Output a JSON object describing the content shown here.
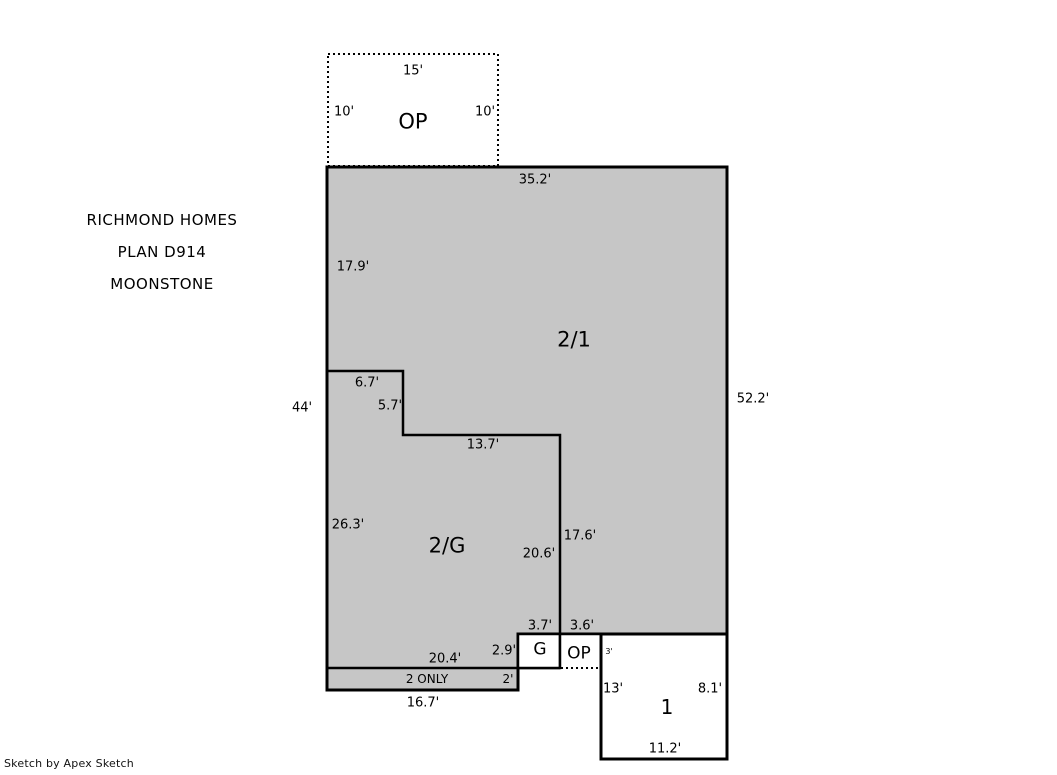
{
  "title_block": {
    "lines": [
      "RICHMOND HOMES",
      "PLAN D914",
      "MOONSTONE"
    ]
  },
  "watermark": {
    "text": "Sketch by Apex Sketch"
  },
  "colors": {
    "area_fill": "#c6c6c6",
    "outline": "#000000",
    "background": "#ffffff",
    "label_text": "#000000"
  },
  "areas": [
    {
      "name": "area-2-1",
      "label": "2/1",
      "meaning": "two story over first floor"
    },
    {
      "name": "area-2-g",
      "label": "2/G",
      "meaning": "second floor over garage"
    },
    {
      "name": "area-g",
      "label": "G",
      "meaning": "garage"
    },
    {
      "name": "area-op-upper",
      "label": "OP",
      "meaning": "open porch"
    },
    {
      "name": "area-op-lower",
      "label": "OP",
      "meaning": "open porch"
    },
    {
      "name": "area-1",
      "label": "1",
      "meaning": "first floor"
    },
    {
      "name": "area-2-only",
      "label": "2 ONLY",
      "meaning": "second floor only strip"
    }
  ],
  "labels": [
    {
      "name": "dim-15ft-porch-top",
      "text": "15'",
      "x": 413,
      "y": 71,
      "size": 13
    },
    {
      "name": "dim-10ft-porch-left",
      "text": "10'",
      "x": 344,
      "y": 112,
      "size": 13
    },
    {
      "name": "area-label-op-upper",
      "text": "OP",
      "x": 413,
      "y": 122,
      "size": 21
    },
    {
      "name": "dim-10ft-porch-right",
      "text": "10'",
      "x": 485,
      "y": 112,
      "size": 13
    },
    {
      "name": "dim-35-2ft-top",
      "text": "35.2'",
      "x": 535,
      "y": 180,
      "size": 13
    },
    {
      "name": "dim-17-9ft-left-upper",
      "text": "17.9'",
      "x": 353,
      "y": 267,
      "size": 13
    },
    {
      "name": "area-label-2-1",
      "text": "2/1",
      "x": 574,
      "y": 340,
      "size": 21
    },
    {
      "name": "dim-6-7ft-step",
      "text": "6.7'",
      "x": 367,
      "y": 383,
      "size": 13
    },
    {
      "name": "dim-44ft-left",
      "text": "44'",
      "x": 302,
      "y": 408,
      "size": 13
    },
    {
      "name": "dim-5-7ft-step",
      "text": "5.7'",
      "x": 390,
      "y": 406,
      "size": 13
    },
    {
      "name": "dim-52-2ft-right",
      "text": "52.2'",
      "x": 753,
      "y": 399,
      "size": 13
    },
    {
      "name": "dim-13-7ft-step",
      "text": "13.7'",
      "x": 483,
      "y": 445,
      "size": 13
    },
    {
      "name": "dim-26-3ft-left-lower",
      "text": "26.3'",
      "x": 348,
      "y": 525,
      "size": 13
    },
    {
      "name": "area-label-2-g",
      "text": "2/G",
      "x": 447,
      "y": 546,
      "size": 21
    },
    {
      "name": "dim-20-6ft-inner",
      "text": "20.6'",
      "x": 539,
      "y": 554,
      "size": 13
    },
    {
      "name": "dim-17-6ft-inner",
      "text": "17.6'",
      "x": 580,
      "y": 536,
      "size": 13
    },
    {
      "name": "dim-3-7ft-garage-top",
      "text": "3.7'",
      "x": 540,
      "y": 626,
      "size": 13
    },
    {
      "name": "dim-3-6ft-porch-top",
      "text": "3.6'",
      "x": 582,
      "y": 626,
      "size": 13
    },
    {
      "name": "dim-2-9ft-garage-left",
      "text": "2.9'",
      "x": 504,
      "y": 651,
      "size": 13
    },
    {
      "name": "area-label-g",
      "text": "G",
      "x": 540,
      "y": 650,
      "size": 17
    },
    {
      "name": "area-label-op-lower",
      "text": "OP",
      "x": 579,
      "y": 654,
      "size": 17
    },
    {
      "name": "dim-3ft-first-top",
      "text": "3'",
      "x": 609,
      "y": 652,
      "size": 8
    },
    {
      "name": "dim-20-4ft-strip-top",
      "text": "20.4'",
      "x": 445,
      "y": 659,
      "size": 13
    },
    {
      "name": "area-label-2-only",
      "text": "2 ONLY",
      "x": 427,
      "y": 679,
      "size": 12
    },
    {
      "name": "dim-2ft-strip",
      "text": "2'",
      "x": 508,
      "y": 679,
      "size": 12
    },
    {
      "name": "dim-13ft-first-left",
      "text": "13'",
      "x": 613,
      "y": 689,
      "size": 13
    },
    {
      "name": "dim-8-1ft-first-right",
      "text": "8.1'",
      "x": 710,
      "y": 689,
      "size": 13
    },
    {
      "name": "dim-16-7ft-strip-bottom",
      "text": "16.7'",
      "x": 423,
      "y": 703,
      "size": 13
    },
    {
      "name": "area-label-1",
      "text": "1",
      "x": 667,
      "y": 707,
      "size": 20
    },
    {
      "name": "dim-11-2ft-first-bottom",
      "text": "11.2'",
      "x": 665,
      "y": 749,
      "size": 13
    }
  ]
}
